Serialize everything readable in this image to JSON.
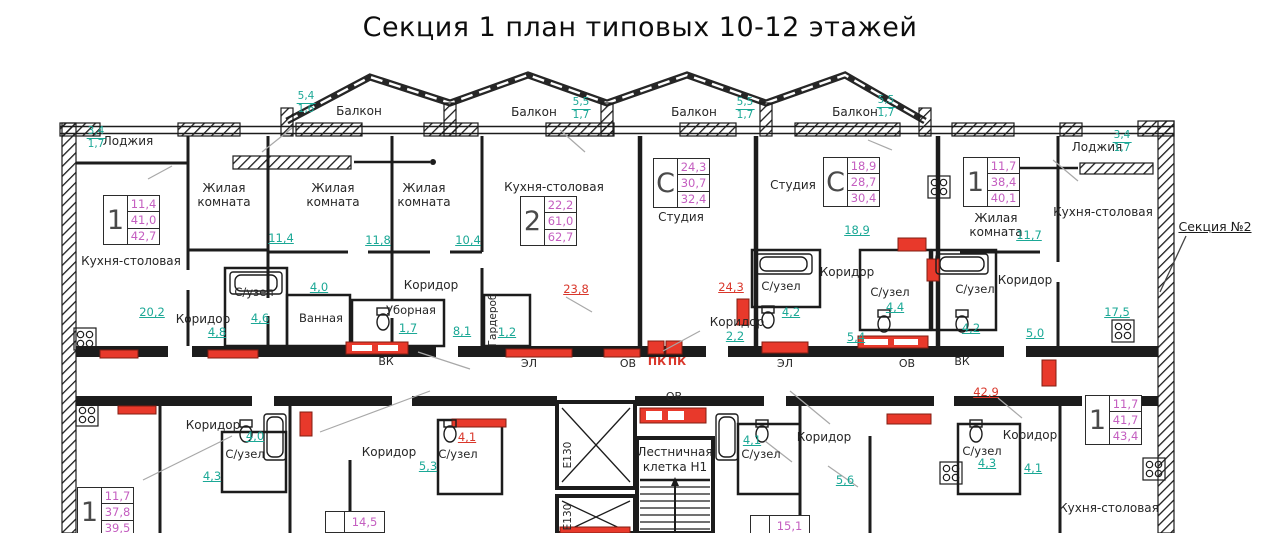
{
  "title": "Секция 1 план типовых 10-12 этажей",
  "section_ref": {
    "label": "Секция №2"
  },
  "colors": {
    "dimension_teal": "#1ba896",
    "area_pink": "#c45ec0",
    "mark_red": "#d9372b",
    "wall_black": "#1c1c1c",
    "leader_gray": "#a8a8a8"
  },
  "balconies": [
    {
      "label": "Балкон",
      "w": "5,4",
      "h": "1,6"
    },
    {
      "label": "Балкон",
      "w": "5,5",
      "h": "1,7"
    },
    {
      "label": "Балкон",
      "w": "5,5",
      "h": "1,7"
    },
    {
      "label": "Балкон",
      "w": "5,5",
      "h": "1,7"
    }
  ],
  "loggias": [
    {
      "label": "Лоджия",
      "w": "3,4",
      "h": "1,7"
    },
    {
      "label": "Лоджия",
      "w": "3,4",
      "h": "1,7"
    }
  ],
  "stamps": [
    {
      "type": "1",
      "values": [
        "11,4",
        "41,0",
        "42,7"
      ]
    },
    {
      "type": "2",
      "values": [
        "22,2",
        "61,0",
        "62,7"
      ]
    },
    {
      "type": "С",
      "values": [
        "24,3",
        "30,7",
        "32,4"
      ]
    },
    {
      "type": "С",
      "values": [
        "18,9",
        "28,7",
        "30,4"
      ]
    },
    {
      "type": "1",
      "values": [
        "11,7",
        "38,4",
        "40,1"
      ]
    },
    {
      "type": "1",
      "values": [
        "11,7",
        "37,8",
        "39,5"
      ]
    },
    {
      "type": "1",
      "values": [
        "11,7",
        "41,7",
        "43,4"
      ]
    }
  ],
  "partial_stamps": [
    {
      "value": "14,5"
    },
    {
      "value": "15,1"
    }
  ],
  "rooms": [
    {
      "label": "Кухня-столовая"
    },
    {
      "label": "Жилая комната"
    },
    {
      "label": "Жилая комната"
    },
    {
      "label": "Жилая комната"
    },
    {
      "label": "Кухня-столовая"
    },
    {
      "label": "Студия"
    },
    {
      "label": "Студия"
    },
    {
      "label": "Жилая комната"
    },
    {
      "label": "Кухня-столовая"
    },
    {
      "label": "С/узел"
    },
    {
      "label": "Ванная"
    },
    {
      "label": "Уборная"
    },
    {
      "label": "Коридор"
    },
    {
      "label": "Коридор"
    },
    {
      "label": "Гардероб"
    },
    {
      "label": "Коридор"
    },
    {
      "label": "С/узел"
    },
    {
      "label": "Коридор"
    },
    {
      "label": "С/узел"
    },
    {
      "label": "С/узел"
    },
    {
      "label": "Коридор"
    },
    {
      "label": "Коридор"
    },
    {
      "label": "С/узел"
    },
    {
      "label": "Коридор"
    },
    {
      "label": "С/узел"
    },
    {
      "label": "С/узел"
    },
    {
      "label": "Коридор"
    },
    {
      "label": "С/узел"
    },
    {
      "label": "Коридор"
    },
    {
      "label": "Кухня-столовая"
    }
  ],
  "dims": [
    {
      "value": "20,2"
    },
    {
      "value": "11,4"
    },
    {
      "value": "11,8"
    },
    {
      "value": "10,4"
    },
    {
      "value": "18,9"
    },
    {
      "value": "11,7"
    },
    {
      "value": "17,5"
    },
    {
      "value": "5,0"
    },
    {
      "value": "4,6"
    },
    {
      "value": "4,8"
    },
    {
      "value": "1,7"
    },
    {
      "value": "4,0"
    },
    {
      "value": "8,1"
    },
    {
      "value": "1,2"
    },
    {
      "value": "2,2"
    },
    {
      "value": "4,2"
    },
    {
      "value": "4,4"
    },
    {
      "value": "5,4"
    },
    {
      "value": "4,2"
    },
    {
      "value": "4,0"
    },
    {
      "value": "4,3"
    },
    {
      "value": "5,3"
    },
    {
      "value": "4,1"
    },
    {
      "value": "5,6"
    },
    {
      "value": "4,3"
    },
    {
      "value": "4,1"
    }
  ],
  "red_dims": [
    {
      "value": "23,8"
    },
    {
      "value": "24,3"
    },
    {
      "value": "4,1"
    },
    {
      "value": "42,9"
    }
  ],
  "red_labels": [
    {
      "label": "ПК"
    },
    {
      "label": "ПК"
    }
  ],
  "shafts": [
    {
      "label": "ВК"
    },
    {
      "label": "ЭЛ"
    },
    {
      "label": "ОВ"
    },
    {
      "label": "ЭЛ"
    },
    {
      "label": "ОВ"
    },
    {
      "label": "ВК"
    },
    {
      "label": "ОВ"
    }
  ],
  "elevators": [
    {
      "label": "Е130"
    },
    {
      "label": "Е130"
    }
  ],
  "stairwell": {
    "line1": "Лестничная",
    "line2": "клетка  Н1"
  }
}
